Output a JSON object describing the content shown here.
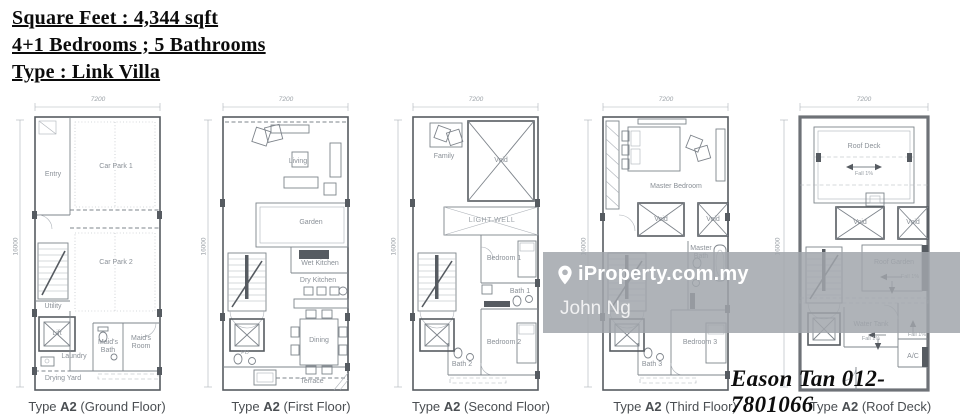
{
  "header": {
    "line1": "Square Feet : 4,344 sqft",
    "line2": "4+1 Bedrooms ; 5 Bathrooms",
    "line3": "Type : Link Villa"
  },
  "watermark": {
    "pin_icon": "map-pin",
    "brand": "iProperty.com.my",
    "user": "John Ng"
  },
  "agent": {
    "contact": "Eason Tan 012-7801066"
  },
  "palette": {
    "wall_line": "#565b61",
    "medium_line": "#7e848b",
    "light_line": "#adb2b8",
    "label_text": "#8a9097",
    "caption_text": "#4a4e52",
    "watermark_bg": "#a1a6ab",
    "watermark_text": "#ffffff"
  },
  "plans": [
    {
      "caption_prefix": "Type",
      "caption_code": "A2",
      "caption_suffix": "(Ground Floor)",
      "width_label": "7200",
      "height_label": "16000",
      "rooms": [
        "Entry",
        "Car Park 1",
        "Car Park 2",
        "Utility",
        "Lift",
        "Laundry",
        "Maid's Bath",
        "Maid's Room",
        "Drying Yard"
      ]
    },
    {
      "caption_prefix": "Type",
      "caption_code": "A2",
      "caption_suffix": "(First Floor)",
      "width_label": "7200",
      "height_label": "16000",
      "rooms": [
        "Living",
        "Garden",
        "Wet Kitchen",
        "Dry Kitchen",
        "Dining",
        "PD",
        "Terrace"
      ]
    },
    {
      "caption_prefix": "Type",
      "caption_code": "A2",
      "caption_suffix": "(Second Floor)",
      "width_label": "7200",
      "height_label": "16000",
      "rooms": [
        "Family",
        "Void",
        "LIGHT WELL",
        "Bedroom 1",
        "Bath 1",
        "Bedroom 2",
        "Bath 2"
      ]
    },
    {
      "caption_prefix": "Type",
      "caption_code": "A2",
      "caption_suffix": "(Third Floor)",
      "width_label": "7200",
      "height_label": "16000",
      "rooms": [
        "Master Bedroom",
        "Void",
        "Void",
        "Master Bath",
        "Bedroom 3",
        "Bath 3"
      ]
    },
    {
      "caption_prefix": "Type",
      "caption_code": "A2",
      "caption_suffix": "(Roof Deck)",
      "width_label": "7200",
      "height_label": "16000",
      "rooms": [
        "Roof Deck",
        "Void",
        "Void",
        "Roof Garden",
        "Water Tank",
        "A/C"
      ],
      "annotations": [
        "Fall 1%",
        "Fall 1%",
        "Fall 1%",
        "Fall 1%"
      ]
    }
  ]
}
